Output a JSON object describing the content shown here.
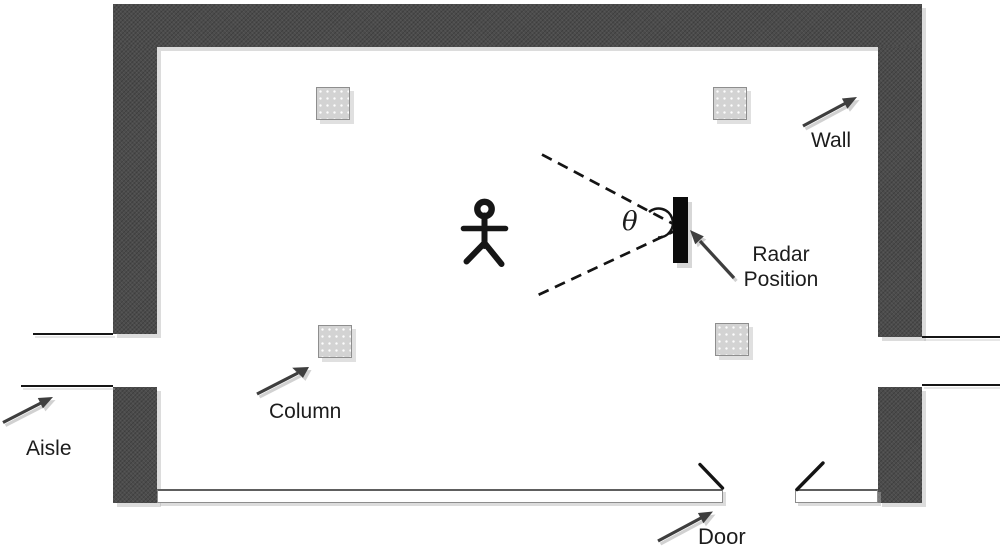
{
  "labels": {
    "wall": "Wall",
    "radar_line1": "Radar",
    "radar_line2": "Position",
    "column": "Column",
    "aisle": "Aisle",
    "door": "Door",
    "theta": "θ"
  },
  "colors": {
    "wall": "#4c4c4c",
    "column_fill": "#d3d3d3",
    "column_border": "#8e8e8e",
    "radar_bar": "#0b0b0b",
    "arrow": "#3e3e3e",
    "line": "#141414",
    "shadow": "#c2c2c2",
    "text": "#1c1c1c",
    "background": "#ffffff"
  },
  "icons": {
    "person": "stick-figure-person",
    "radar": "vertical-black-bar",
    "beam": "dashed-angle-lines-with-arc"
  },
  "structure": {
    "wall_segments": 5,
    "columns": 4,
    "door_leaves": 2,
    "floor_bars": 2,
    "aisle_guide_lines": 4,
    "arrows": 5
  }
}
